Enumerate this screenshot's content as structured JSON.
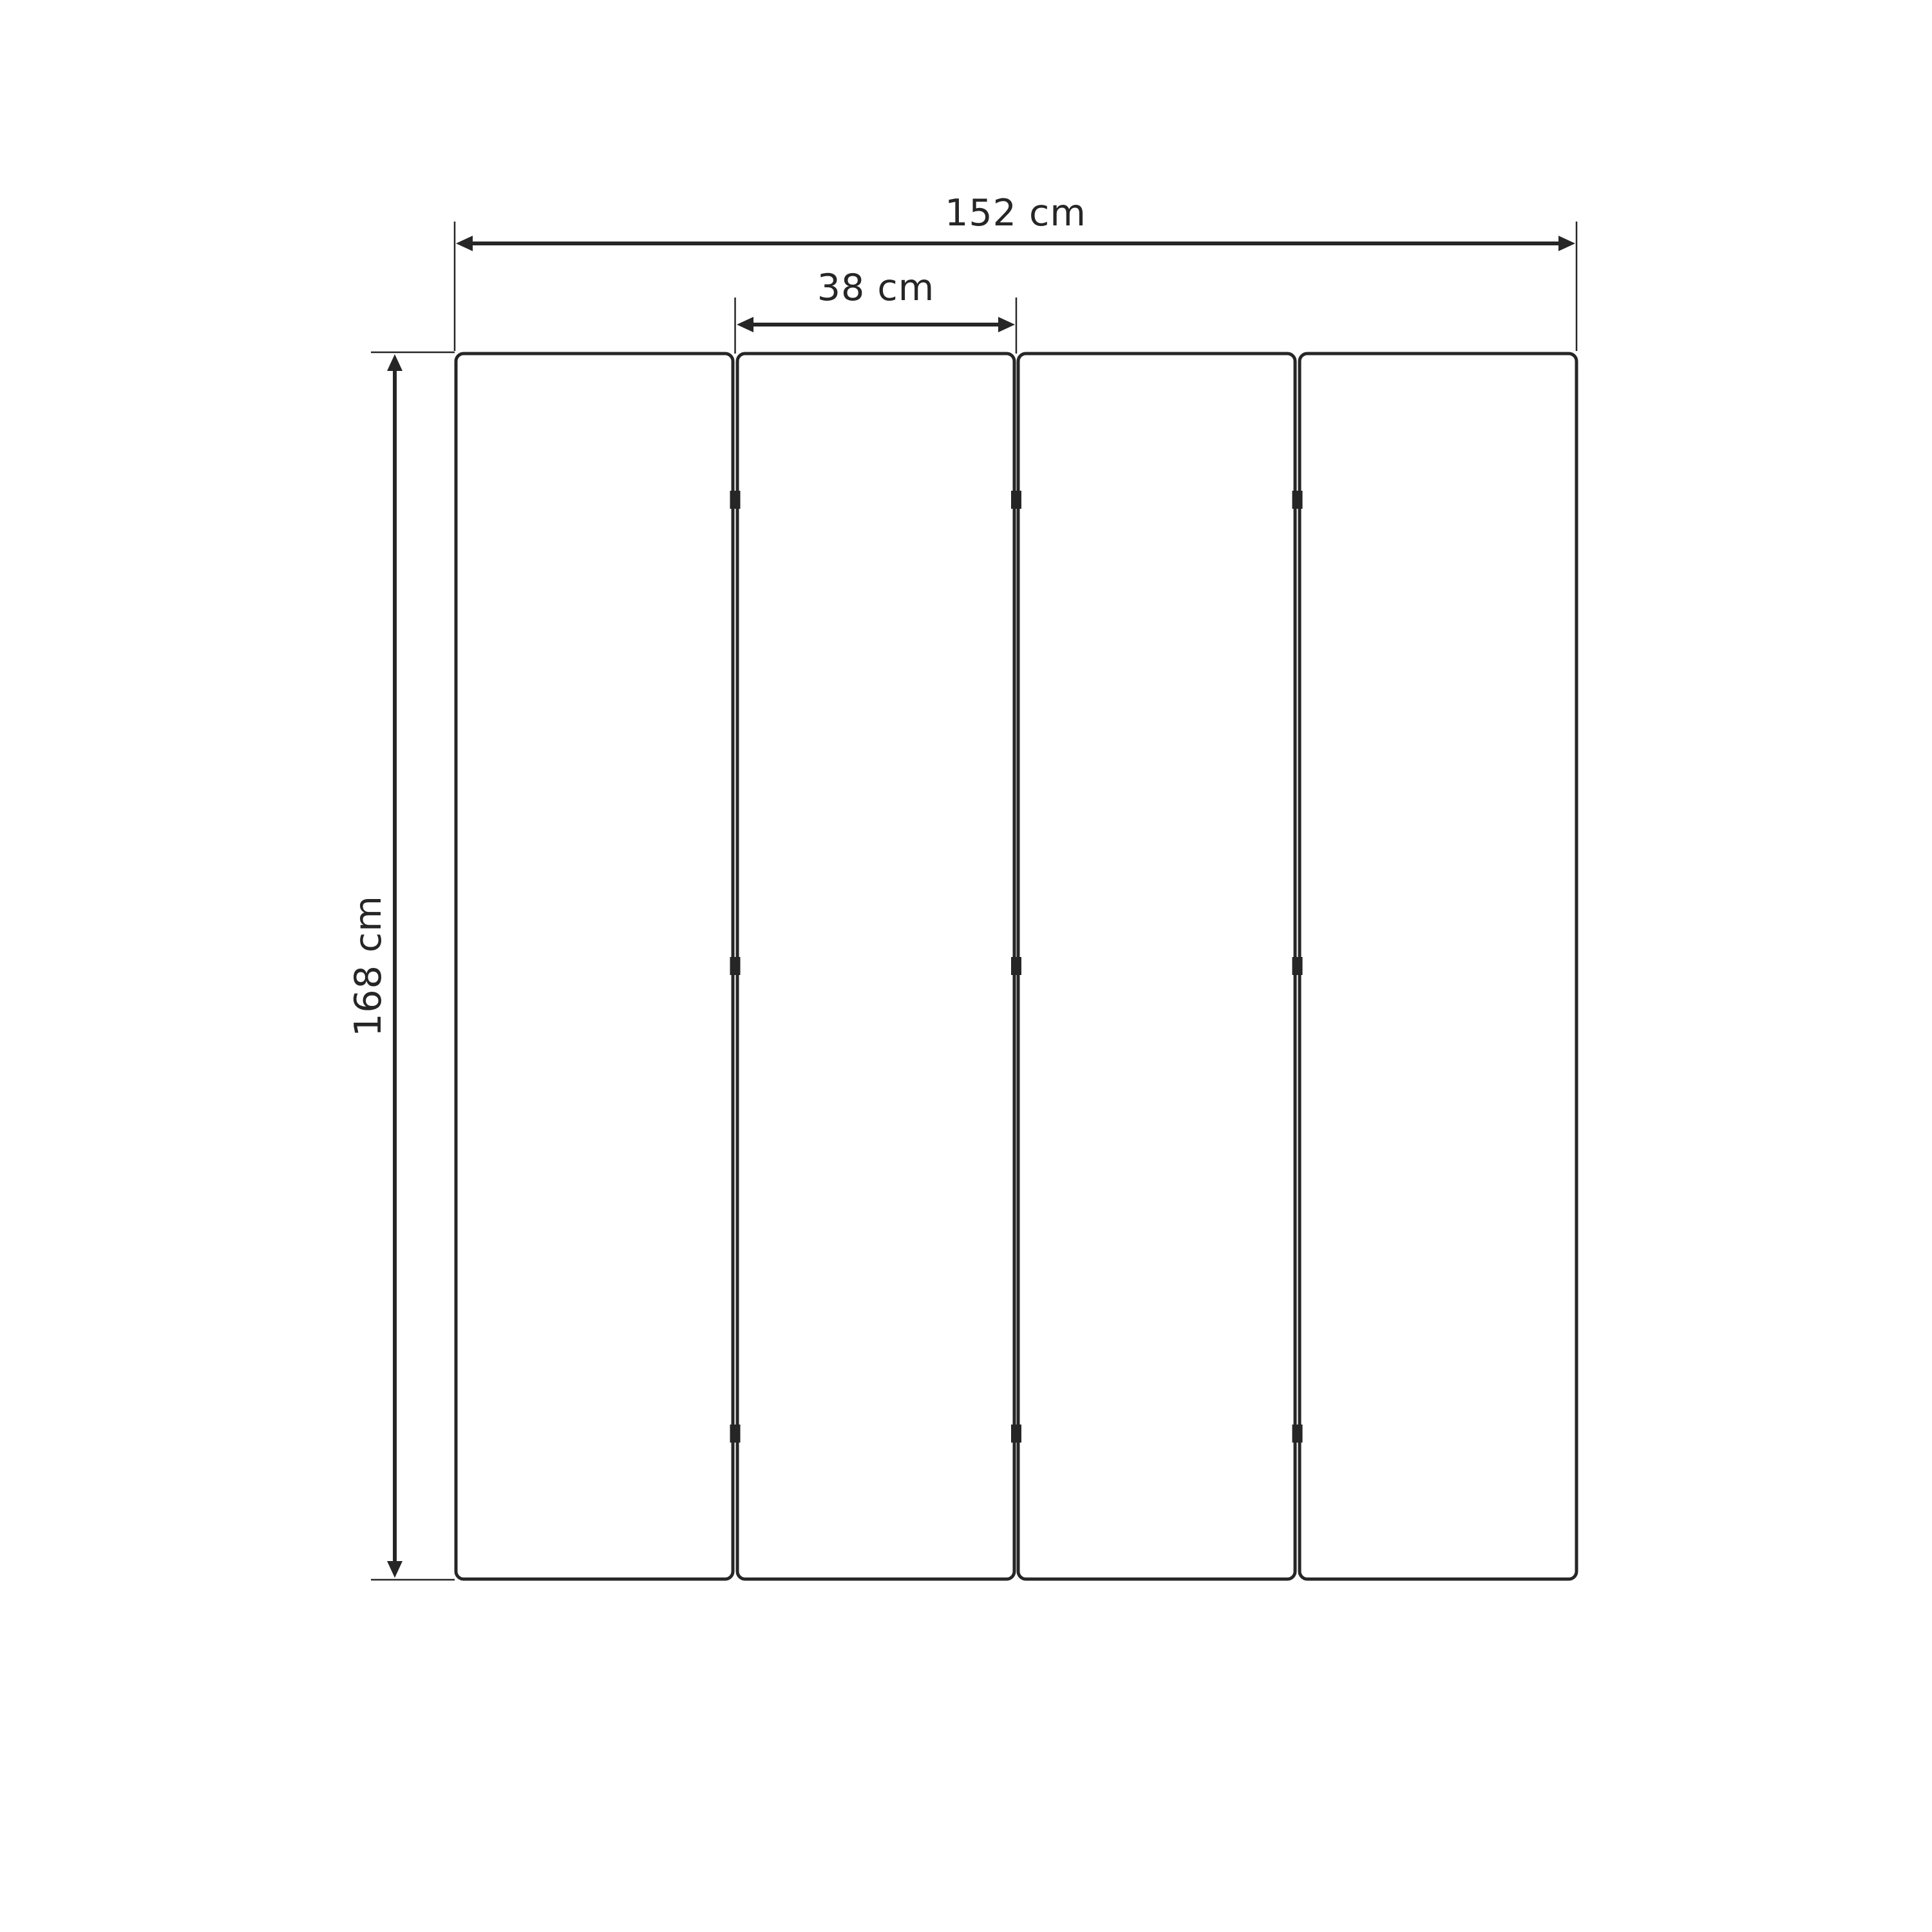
{
  "diagram": {
    "name": "four-panel folding screen dimension drawing",
    "unit": "cm",
    "panel_count": 4,
    "dimensions": {
      "total_width": {
        "label": "152 cm",
        "value": 152
      },
      "panel_width": {
        "label": "38 cm",
        "value": 38
      },
      "height": {
        "label": "168 cm",
        "value": 168
      }
    },
    "colors": {
      "line": "#262626",
      "panel_fill": "#ffffff",
      "background": "#ffffff"
    }
  }
}
